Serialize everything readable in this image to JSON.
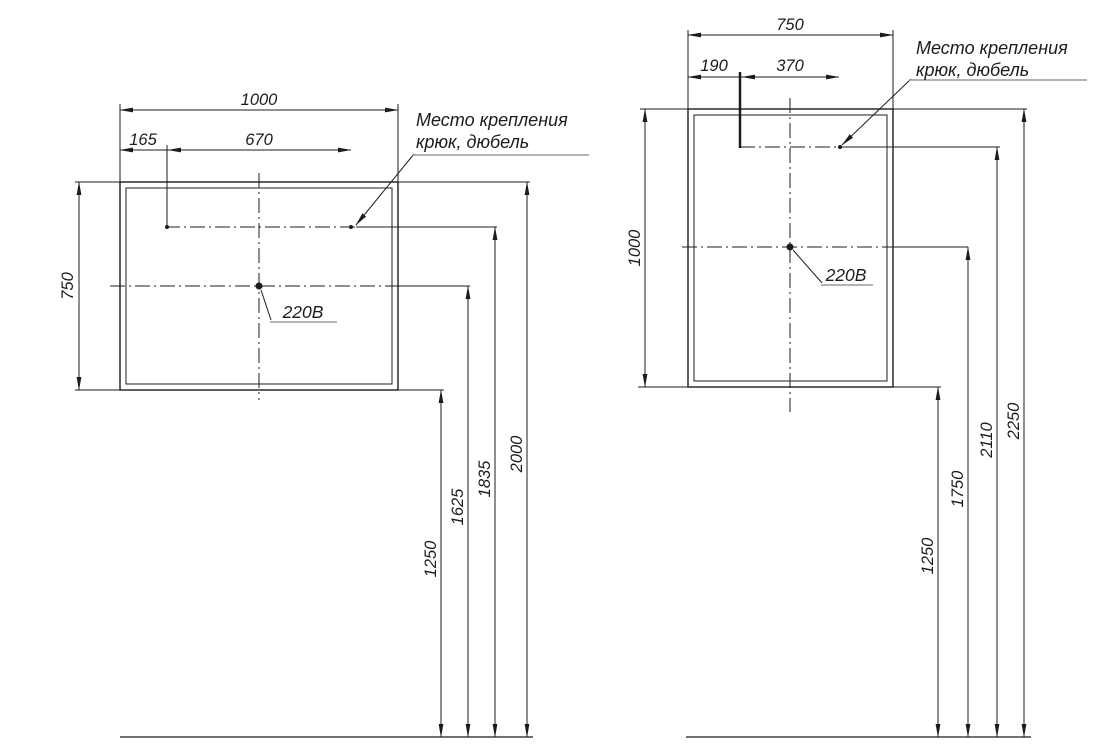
{
  "page": {
    "background_color": "#ffffff",
    "line_color": "#1c1c1c",
    "leader_underline_color": "#9a9a9a"
  },
  "left_drawing": {
    "width": "1000",
    "hook_offset": "165",
    "hook_spacing": "670",
    "height": "750",
    "mount_note": [
      "Место крепления",
      "крюк, дюбель"
    ],
    "power": "220В",
    "heights": [
      "1250",
      "1625",
      "1835",
      "2000"
    ]
  },
  "right_drawing": {
    "width": "750",
    "hook_offset": "190",
    "hook_spacing": "370",
    "height": "1000",
    "mount_note": [
      "Место крепления",
      "крюк, дюбель"
    ],
    "power": "220В",
    "heights": [
      "1250",
      "1750",
      "2110",
      "2250"
    ]
  }
}
